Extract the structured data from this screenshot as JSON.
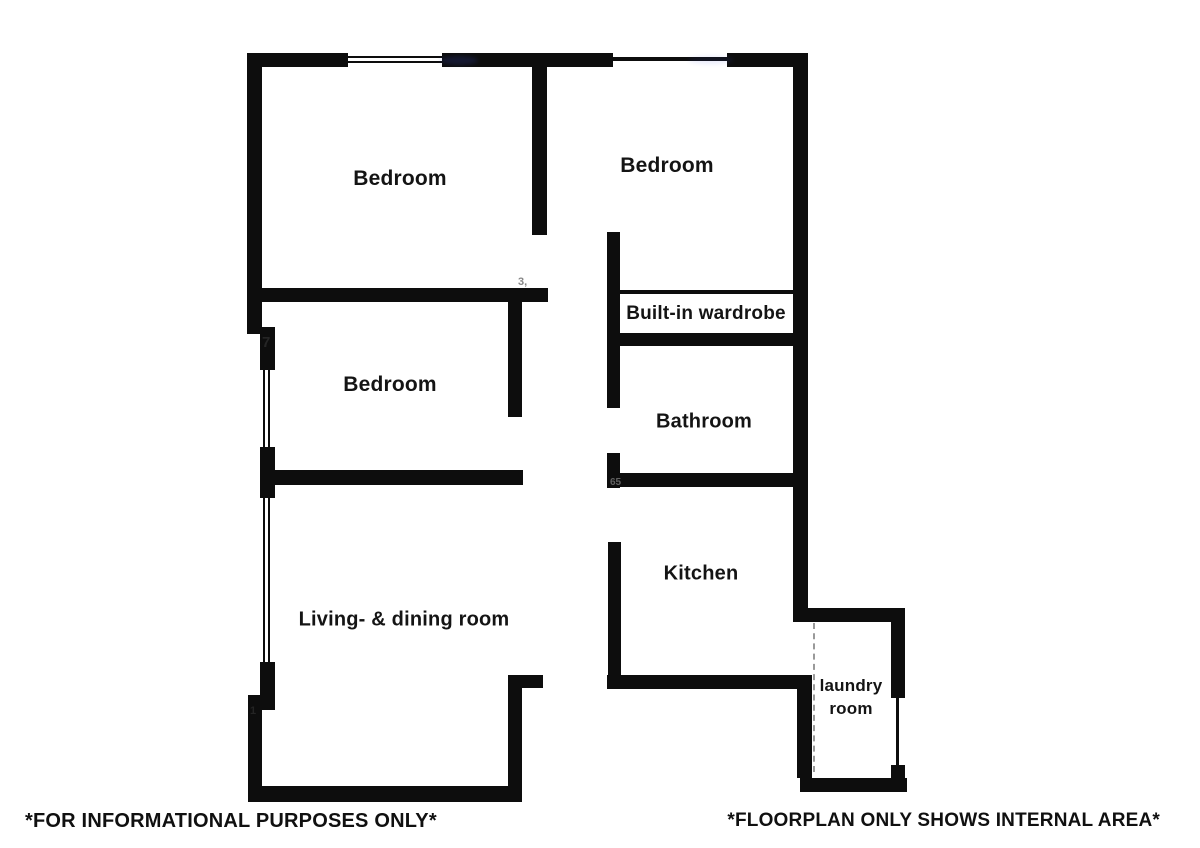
{
  "plan": {
    "wall_color": "#0d0d0d",
    "background_color": "#ffffff",
    "walls": [
      [
        247,
        53,
        101,
        14
      ],
      [
        442,
        53,
        171,
        14
      ],
      [
        727,
        53,
        80,
        14
      ],
      [
        247,
        53,
        15,
        280
      ],
      [
        247,
        327,
        28,
        7
      ],
      [
        260,
        333,
        15,
        37
      ],
      [
        260,
        447,
        15,
        51
      ],
      [
        260,
        662,
        15,
        48
      ],
      [
        248,
        695,
        27,
        15
      ],
      [
        248,
        710,
        14,
        92
      ],
      [
        248,
        786,
        274,
        16
      ],
      [
        508,
        675,
        14,
        127
      ],
      [
        508,
        675,
        35,
        13
      ],
      [
        532,
        55,
        15,
        180
      ],
      [
        250,
        288,
        298,
        14
      ],
      [
        508,
        300,
        14,
        117
      ],
      [
        260,
        470,
        263,
        15
      ],
      [
        793,
        53,
        15,
        569
      ],
      [
        607,
        232,
        13,
        176
      ],
      [
        607,
        453,
        13,
        35
      ],
      [
        618,
        290,
        175,
        4
      ],
      [
        612,
        333,
        186,
        13
      ],
      [
        607,
        473,
        188,
        14
      ],
      [
        608,
        542,
        13,
        146
      ],
      [
        607,
        675,
        205,
        14
      ],
      [
        797,
        675,
        15,
        103
      ],
      [
        800,
        778,
        107,
        14
      ],
      [
        793,
        608,
        112,
        14
      ],
      [
        891,
        608,
        14,
        90
      ],
      [
        891,
        765,
        14,
        27
      ]
    ],
    "windows": [
      {
        "x": 348,
        "y": 53,
        "w": 94,
        "h": 14,
        "style": "h-triple"
      },
      {
        "x": 613,
        "y": 53,
        "w": 114,
        "h": 14,
        "style": "h-line"
      },
      {
        "x": 260,
        "y": 370,
        "w": 14,
        "h": 77,
        "style": "v-double"
      },
      {
        "x": 260,
        "y": 498,
        "w": 14,
        "h": 164,
        "style": "v-double"
      },
      {
        "x": 891,
        "y": 698,
        "w": 14,
        "h": 67,
        "style": "v-line"
      }
    ],
    "dashed_line": {
      "x": 813,
      "y": 623,
      "h": 149
    },
    "rooms": [
      {
        "id": "bedroom-1",
        "label": "Bedroom",
        "cx": 400,
        "cy": 179,
        "size": 21
      },
      {
        "id": "bedroom-2",
        "label": "Bedroom",
        "cx": 667,
        "cy": 166,
        "size": 21
      },
      {
        "id": "bedroom-3",
        "label": "Bedroom",
        "cx": 390,
        "cy": 385,
        "size": 21
      },
      {
        "id": "built-in-wardrobe",
        "label": "Built-in wardrobe",
        "cx": 706,
        "cy": 314,
        "size": 19
      },
      {
        "id": "bathroom",
        "label": "Bathroom",
        "cx": 704,
        "cy": 422,
        "size": 20
      },
      {
        "id": "kitchen",
        "label": "Kitchen",
        "cx": 701,
        "cy": 574,
        "size": 20
      },
      {
        "id": "living-dining-room",
        "label": "Living- & dining room",
        "cx": 404,
        "cy": 620,
        "size": 20
      },
      {
        "id": "laundry-room",
        "label": "laundry\nroom",
        "cx": 851,
        "cy": 698,
        "size": 17
      }
    ],
    "artifacts": [
      {
        "text": "7",
        "x": 262,
        "y": 334,
        "size": 15,
        "color": "#2a2a2a",
        "opacity": 0.85
      },
      {
        "text": "1",
        "x": 250,
        "y": 705,
        "size": 11,
        "color": "#2a2a2a",
        "opacity": 0.8
      },
      {
        "text": "3,",
        "x": 518,
        "y": 276,
        "size": 11,
        "color": "#555555",
        "opacity": 0.7
      },
      {
        "text": "65",
        "x": 610,
        "y": 477,
        "size": 10,
        "color": "#999999",
        "opacity": 0.6
      }
    ],
    "smudges": [
      {
        "x": 440,
        "y": 56,
        "w": 38,
        "h": 9,
        "color": "#3b4fd8",
        "opacity": 0.18
      },
      {
        "x": 688,
        "y": 56,
        "w": 46,
        "h": 8,
        "color": "#3b4fd8",
        "opacity": 0.1
      }
    ]
  },
  "footer": {
    "left": "*FOR INFORMATIONAL PURPOSES ONLY*",
    "right": "*FLOORPLAN ONLY SHOWS INTERNAL AREA*"
  }
}
